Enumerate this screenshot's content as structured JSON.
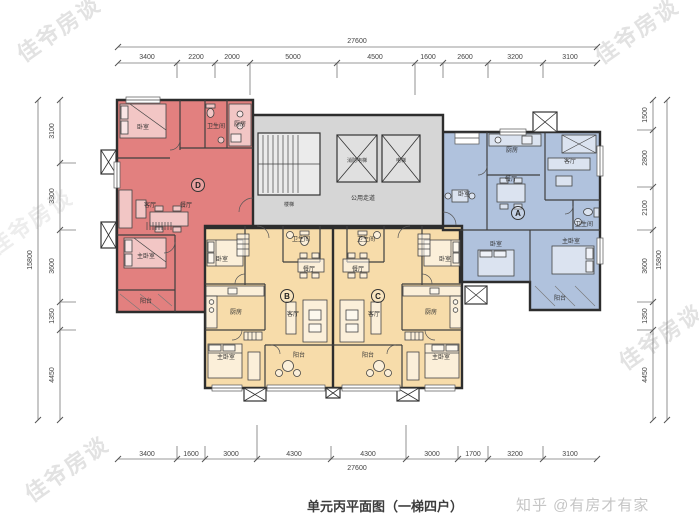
{
  "title": "单元丙平面图（一梯四户）",
  "brand": "知乎 @有房才有家",
  "watermark": "佳爷房谈",
  "colors": {
    "unit_d": "#e2807f",
    "unit_a": "#b0c2dd",
    "unit_bc": "#f7dcaa",
    "core": "#d6d6d6"
  },
  "dims": {
    "top_total": "27600",
    "top": [
      "3400",
      "2200",
      "2000",
      "5000",
      "4500",
      "1600",
      "2600",
      "3200",
      "3100"
    ],
    "bottom": [
      "3400",
      "1600",
      "3000",
      "4300",
      "4300",
      "3000",
      "1700",
      "3200",
      "3100"
    ],
    "bottom_total": "27600",
    "left_total": "15800",
    "left": [
      "3100",
      "3300",
      "3600",
      "1350",
      "4450"
    ],
    "right": [
      "1500",
      "2800",
      "2100",
      "3600",
      "1350",
      "4450"
    ],
    "right_total": "15800"
  },
  "core": {
    "corridor": "公用走道",
    "stair": "楼梯",
    "elevator_fire": "消防电梯",
    "elevator": "电梯"
  },
  "units": {
    "d": {
      "tag": "D",
      "bedroom": "卧室",
      "bath": "卫生间",
      "kitchen": "厨房",
      "living": "客厅",
      "dining": "餐厅",
      "master": "主卧室",
      "balcony": "阳台"
    },
    "a": {
      "tag": "A",
      "bedroom": "卧室",
      "bedroom2": "卧室",
      "bath": "卫生间",
      "kitchen": "厨房",
      "living": "客厅",
      "dining": "餐厅",
      "master": "主卧室",
      "balcony": "阳台"
    },
    "b": {
      "tag": "B",
      "bedroom": "卧室",
      "bath": "卫生间",
      "kitchen": "厨房",
      "living": "客厅",
      "dining": "餐厅",
      "master": "主卧室",
      "balcony": "阳台"
    },
    "c": {
      "tag": "C",
      "bedroom": "卧室",
      "bath": "卫生间",
      "kitchen": "厨房",
      "living": "客厅",
      "dining": "餐厅",
      "master": "主卧室",
      "balcony": "阳台"
    }
  }
}
